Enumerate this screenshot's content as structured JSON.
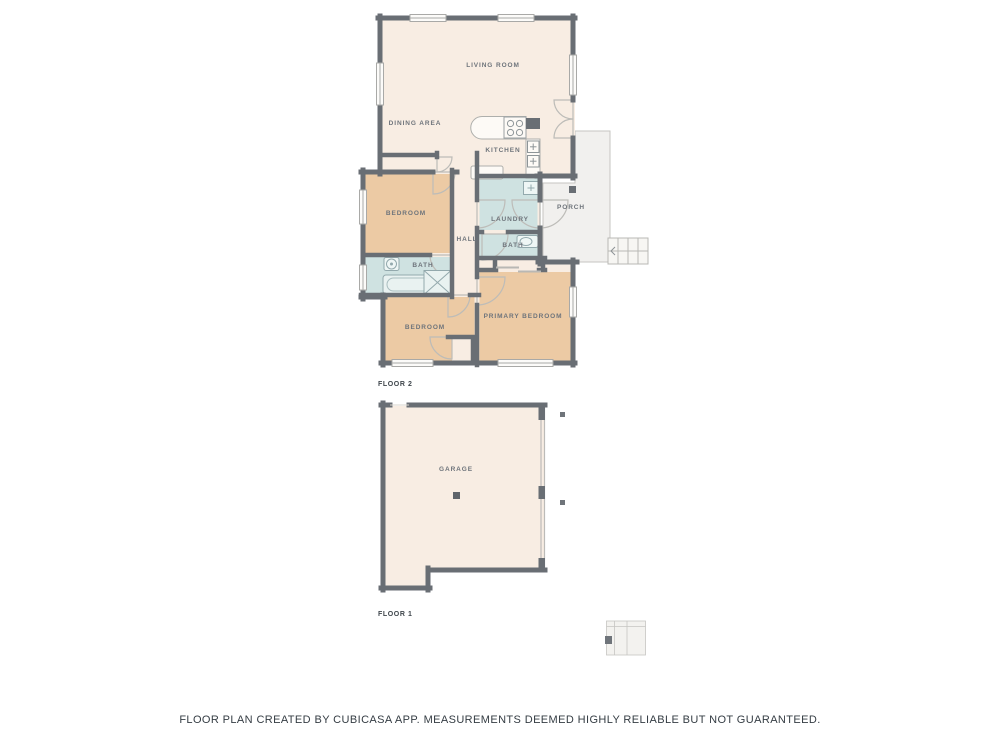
{
  "floor2": {
    "label": "FLOOR 2",
    "rooms": {
      "living_room": "LIVING ROOM",
      "dining_area": "DINING AREA",
      "kitchen": "KITCHEN",
      "bedroom_left": "BEDROOM",
      "laundry": "LAUNDRY",
      "porch": "PORCH",
      "hall": "HALL",
      "bath_left": "BATH",
      "bath_right": "BATH",
      "bedroom_bottom": "BEDROOM",
      "primary_bedroom": "PRIMARY BEDROOM"
    }
  },
  "floor1": {
    "label": "FLOOR 1",
    "rooms": {
      "garage": "GARAGE"
    }
  },
  "footer": {
    "disclaimer": "FLOOR PLAN CREATED BY CUBICASA APP. MEASUREMENTS DEEMED HIGHLY RELIABLE BUT NOT GUARANTEED."
  },
  "colors": {
    "wall": "#696e74",
    "floor": "#f8ede3",
    "bedroom_fill": "#eccaa4",
    "wet_room_fill": "#cfe2e1",
    "porch_fill": "#f1f0ee",
    "thin_line": "#bdbcb8",
    "room_label_text": "#6e747b",
    "floor_label_text": "#3f464c",
    "footer_text": "#343c43"
  }
}
